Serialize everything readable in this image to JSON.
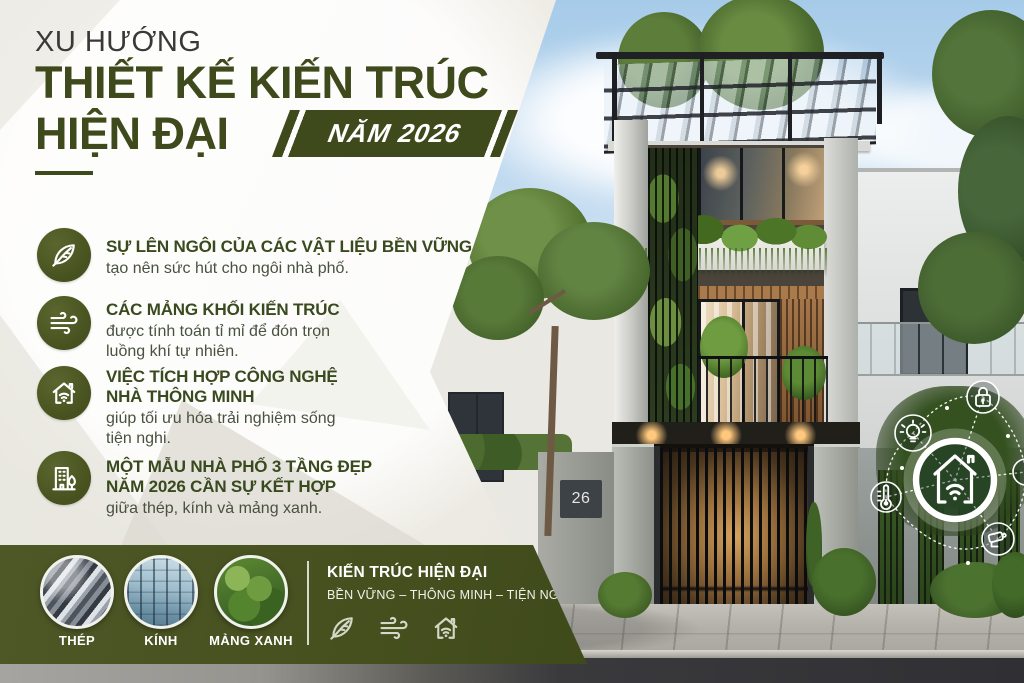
{
  "title": {
    "eyebrow": "XU HƯỚNG",
    "line1": "THIẾT KẾ KIẾN TRÚC",
    "line2": "HIỆN ĐẠI",
    "badge": "NĂM 2026"
  },
  "bullets": [
    {
      "icon": "leaf-icon",
      "heading": "SỰ LÊN NGÔI CỦA CÁC VẬT LIỆU BỀN VỮNG",
      "body": "tạo nên sức hút cho ngôi nhà phố."
    },
    {
      "icon": "wind-icon",
      "heading": "CÁC MẢNG KHỐI KIẾN TRÚC",
      "body": "được tính toán tỉ mỉ để đón trọn\nluồng khí tự nhiên."
    },
    {
      "icon": "smart-home-icon",
      "heading": "VIỆC TÍCH HỢP CÔNG NGHỆ\nNHÀ THÔNG MINH",
      "body": "giúp tối ưu hóa trải nghiệm sống\ntiện nghi."
    },
    {
      "icon": "building-tree-icon",
      "heading": "MỘT MẪU NHÀ PHỐ 3 TẦNG ĐẸP\nNĂM 2026 CẦN SỰ KẾT HỢP",
      "body": "giữa thép, kính và mảng xanh."
    }
  ],
  "footer": {
    "items": [
      {
        "label": "THÉP",
        "image": "steel-beams-photo"
      },
      {
        "label": "KÍNH",
        "image": "glass-facade-photo"
      },
      {
        "label": "MẢNG XANH",
        "image": "green-wall-photo"
      }
    ],
    "heading": "KIẾN TRÚC HIỆN ĐẠI",
    "subheading": "BỀN VỮNG – THÔNG MINH – TIỆN NGHI",
    "icons": [
      "leaf-icon",
      "wind-icon",
      "smart-home-icon"
    ]
  },
  "photo": {
    "house_number": "26",
    "smart_home_icons": [
      "smart-home-hub-icon",
      "lock-icon",
      "lightbulb-icon",
      "thermometer-icon",
      "cctv-camera-icon"
    ]
  },
  "colors": {
    "accent_green": "#3e491c",
    "bar_green": "#47511f",
    "badge_green": "#3f4a1c",
    "heading_green": "#3a4a1f",
    "body_text": "#49513f",
    "background_cream": "#f2f0ea",
    "sky_blue": "#a6cbe9",
    "white": "#ffffff"
  }
}
